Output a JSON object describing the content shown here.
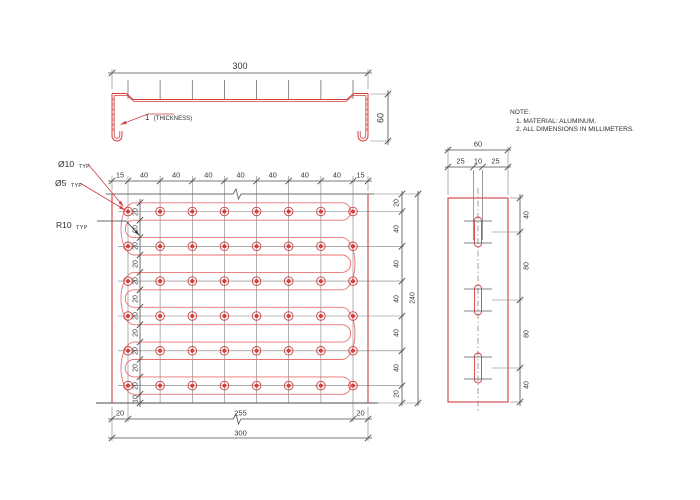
{
  "note": {
    "heading": "NOTE:",
    "items": [
      "1. MATERIAL: ALUMINUM.",
      "2. ALL DIMENSIONS IN MILLIMETERS."
    ]
  },
  "profile_view": {
    "overall_width": "300",
    "overall_height": "60",
    "thickness_value": "1",
    "thickness_caption": "(THICKNESS)"
  },
  "plan_view": {
    "top_dims": [
      "15",
      "40",
      "40",
      "40",
      "40",
      "40",
      "40",
      "40",
      "15"
    ],
    "pitch_dims": [
      "20",
      "20",
      "20",
      "20",
      "20",
      "20",
      "20",
      "20",
      "20",
      "20",
      "20"
    ],
    "pitch_bottom_dim": "10",
    "right_dims": [
      "20",
      "40",
      "40",
      "40",
      "40",
      "40",
      "20"
    ],
    "right_overall": "240",
    "bottom_dims": [
      "20",
      "255",
      "20"
    ],
    "bottom_overall": "300",
    "hole_callout": "Ø10",
    "hole_callout_suffix": "TYP",
    "inner_hole_callout": "Ø5",
    "inner_hole_callout_suffix": "TYP",
    "radius_callout": "R10",
    "radius_callout_suffix": "TYP"
  },
  "side_view": {
    "overall_width": "60",
    "width_dims": [
      "25",
      "10",
      "25"
    ],
    "right_dims": [
      "40",
      "80",
      "80",
      "40"
    ]
  },
  "colors": {
    "red": "#d23f3f",
    "red_light": "#e87272",
    "dim_line": "#4d4d4d",
    "centerline": "#7d7d7d",
    "edge_gray": "#6e6e6e"
  }
}
